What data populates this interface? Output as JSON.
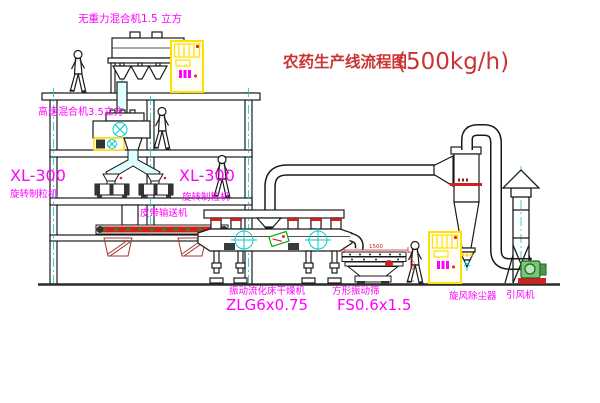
{
  "diagram_title": {
    "text": "农药生产线流程图",
    "capacity": "(500kg/h)"
  },
  "labels": {
    "gravity_free_mixer": "无重力混合机1.5 立方",
    "high_speed_mixer": "高速混合机3.5立方",
    "granulator_left_model": "XL-300",
    "granulator_left_name": "旋转制粒机",
    "granulator_right_model": "XL-300",
    "granulator_right_name": "旋转制粒机",
    "belt_conveyor": "皮带输送机",
    "fluid_bed_dryer_name": "振动流化床干燥机",
    "fluid_bed_dryer_model": "ZLG6x0.75",
    "vibrating_screen_name": "方形振动筛",
    "vibrating_screen_model": "FS0.6x1.5",
    "cyclone_dust_collector": "旋风除尘器",
    "induced_draft_fan": "引风机"
  },
  "dimensions": {
    "screen_length": "1500",
    "screen_height": "345"
  },
  "figures": {
    "worker_count": 4
  },
  "colors": {
    "label_magenta": "#ff00ff",
    "title_red": "#cc3333",
    "centerline_cyan": "#00cccc",
    "equipment_yellow": "#ffe000",
    "belt_red": "#cc2222",
    "fan_green": "#7cc47c",
    "drawing_line": "#1a1a1a"
  }
}
